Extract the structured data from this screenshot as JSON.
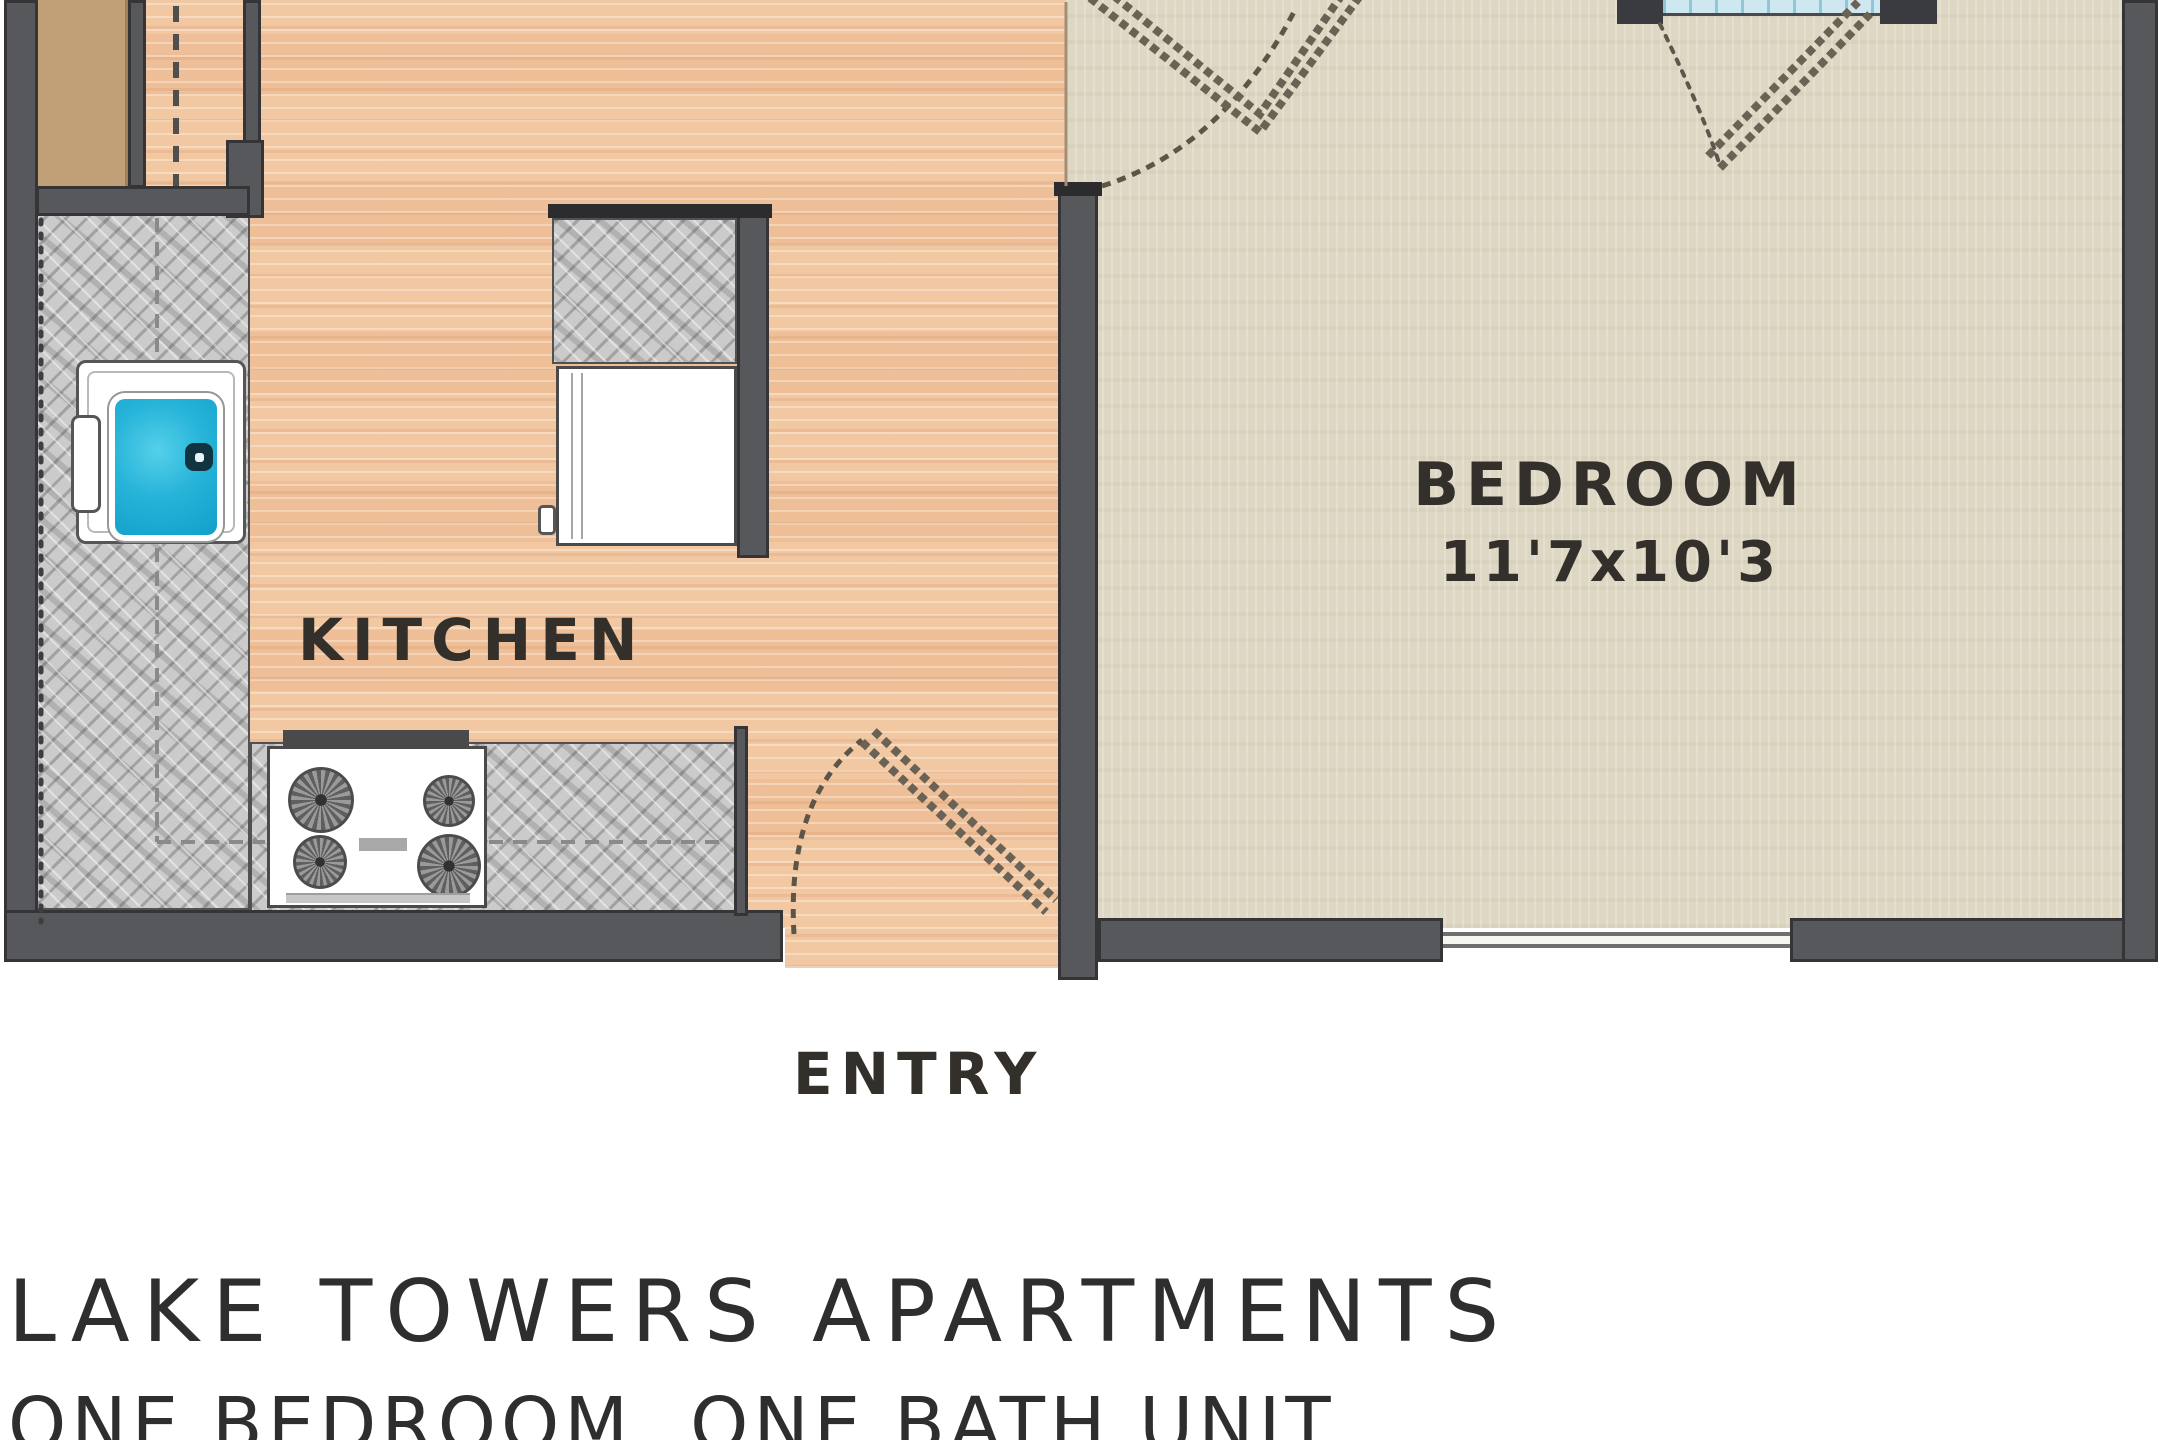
{
  "plan": {
    "title": "LAKE TOWERS APARTMENTS",
    "subtitle": "ONE BEDROOM, ONE BATH UNIT",
    "entry_label": "ENTRY",
    "rooms": {
      "kitchen": {
        "label": "KITCHEN"
      },
      "bedroom": {
        "label": "BEDROOM",
        "dimensions": "11'7x10'3"
      }
    },
    "fixtures": [
      "kitchen-sink",
      "range-stove",
      "refrigerator",
      "island-counter",
      "entry-door-swing",
      "bedroom-door-swing",
      "balcony-door-swing",
      "window",
      "closet-cabinet"
    ],
    "colors": {
      "wall": "#57585c",
      "wood_floor": "#f2c8a3",
      "carpet": "#ded7c3",
      "counter": "#cbcbcb",
      "cabinet_tan": "#c2a077",
      "sink_basin": "#27b4d9",
      "window_glass": "#cfe7f0",
      "label_text": "#33302b",
      "title_text": "#2e2e2e"
    }
  }
}
